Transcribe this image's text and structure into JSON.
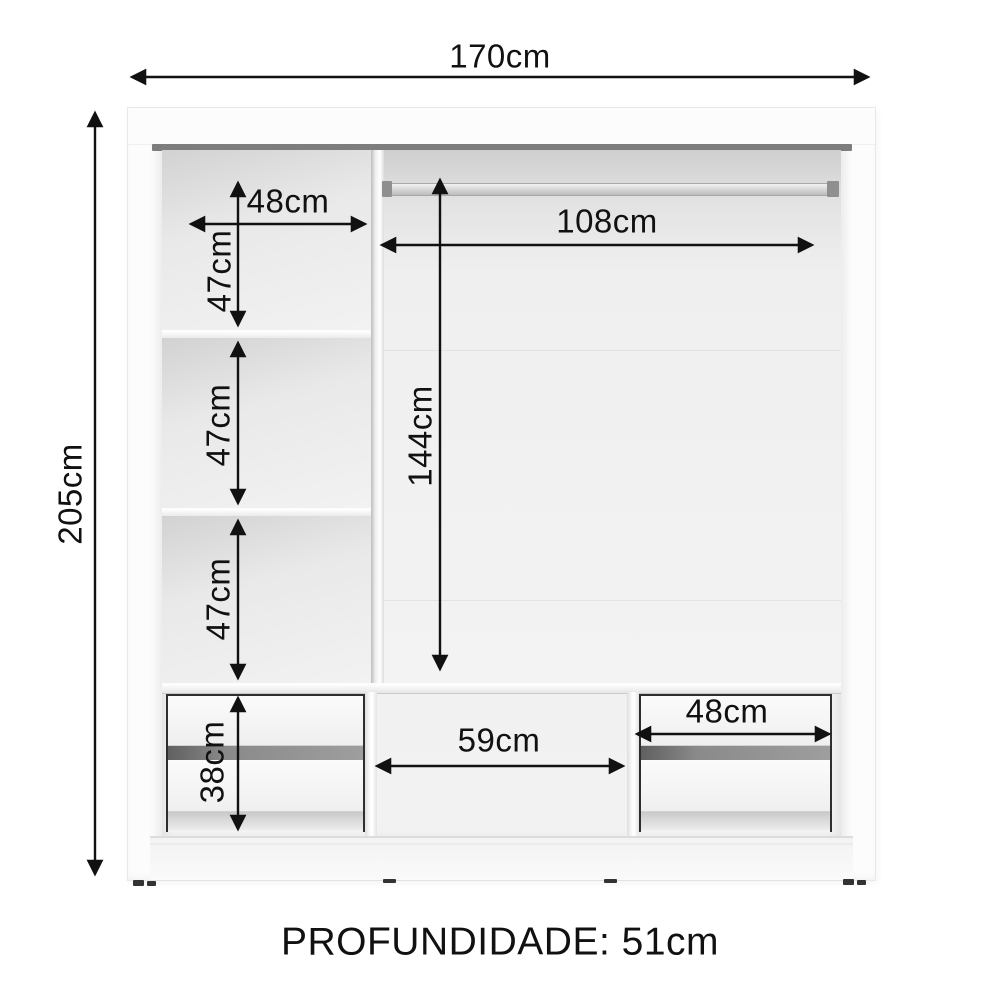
{
  "colors": {
    "background": "#ffffff",
    "annotation": "#111111",
    "rail_gray": "#7d7d7d",
    "cabinet_white": "#fbfbfb",
    "interior_gray": "#ededed"
  },
  "labels": {
    "total_width": "170cm",
    "total_height": "205cm",
    "left_shelf_width": "48cm",
    "left_shelf_height_top": "47cm",
    "left_shelf_height_middle": "47cm",
    "left_shelf_height_bottom": "47cm",
    "rod_width": "108cm",
    "hanging_height": "144cm",
    "drawer_section_height": "38cm",
    "center_section_width": "59cm",
    "right_drawer_width": "48cm",
    "depth_note": "PROFUNDIDADE: 51cm"
  }
}
